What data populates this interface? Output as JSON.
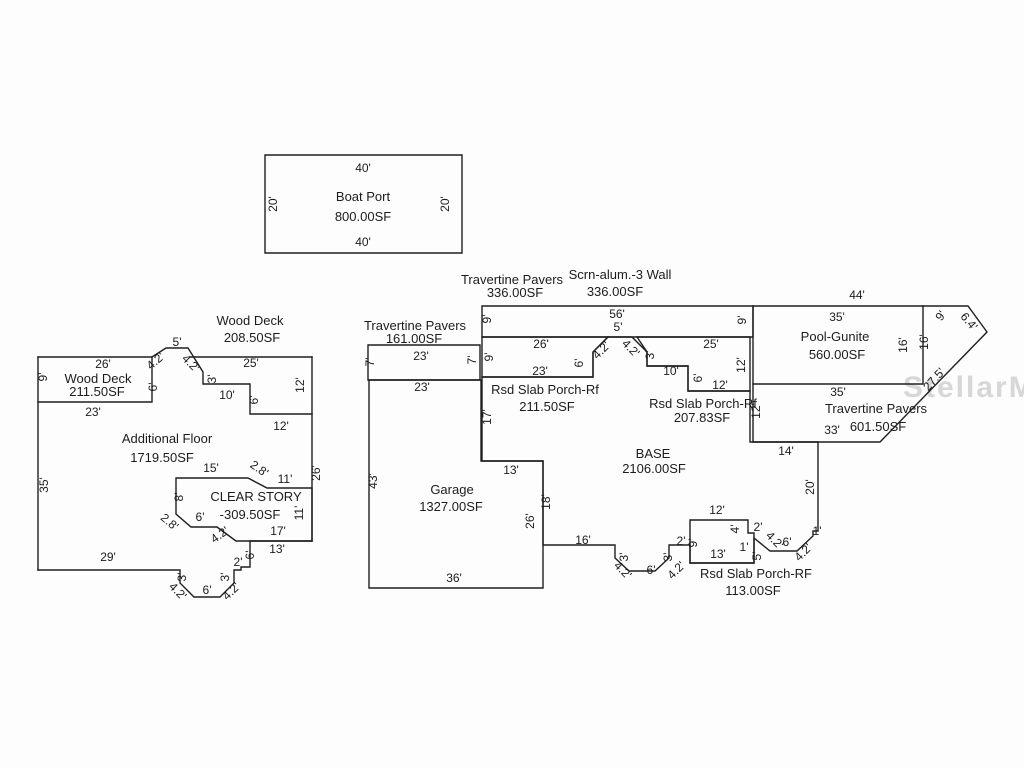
{
  "watermark": "StellarMLS",
  "diagram": {
    "groups": [
      {
        "name": "boat-port",
        "labels": [
          {
            "t": "40'",
            "x": 363,
            "y": 172,
            "cls": "dim"
          },
          {
            "t": "Boat Port",
            "x": 363,
            "y": 201,
            "cls": "area"
          },
          {
            "t": "800.00SF",
            "x": 363,
            "y": 221,
            "cls": "area"
          },
          {
            "t": "40'",
            "x": 363,
            "y": 246,
            "cls": "dim"
          },
          {
            "t": "20'",
            "x": 277,
            "y": 204,
            "r": -90,
            "cls": "dim"
          },
          {
            "t": "20'",
            "x": 449,
            "y": 204,
            "r": -90,
            "cls": "dim"
          }
        ]
      },
      {
        "name": "left-building",
        "labels": [
          {
            "t": "Wood Deck",
            "x": 250,
            "y": 325,
            "cls": "area"
          },
          {
            "t": "208.50SF",
            "x": 252,
            "y": 342,
            "cls": "area"
          },
          {
            "t": "26'",
            "x": 103,
            "y": 368,
            "cls": "dim"
          },
          {
            "t": "5'",
            "x": 177,
            "y": 346,
            "cls": "dim"
          },
          {
            "t": "4.2'",
            "x": 158,
            "y": 364,
            "r": -40,
            "cls": "dim"
          },
          {
            "t": "4.2'",
            "x": 188,
            "y": 366,
            "r": 45,
            "cls": "dim"
          },
          {
            "t": "25'",
            "x": 251,
            "y": 367,
            "cls": "dim"
          },
          {
            "t": "9'",
            "x": 47,
            "y": 377,
            "r": -90,
            "cls": "dim"
          },
          {
            "t": "Wood Deck",
            "x": 98,
            "y": 383,
            "cls": "area"
          },
          {
            "t": "211.50SF",
            "x": 97,
            "y": 396,
            "cls": "area"
          },
          {
            "t": "23'",
            "x": 93,
            "y": 416,
            "cls": "dim"
          },
          {
            "t": "6'",
            "x": 157,
            "y": 387,
            "r": -90,
            "cls": "dim"
          },
          {
            "t": "3'",
            "x": 216,
            "y": 379,
            "r": -90,
            "cls": "dim"
          },
          {
            "t": "10'",
            "x": 227,
            "y": 399,
            "cls": "dim"
          },
          {
            "t": "6'",
            "x": 258,
            "y": 400,
            "r": -90,
            "cls": "dim"
          },
          {
            "t": "12'",
            "x": 304,
            "y": 385,
            "r": -90,
            "cls": "dim"
          },
          {
            "t": "12'",
            "x": 281,
            "y": 430,
            "cls": "dim"
          },
          {
            "t": "26'",
            "x": 320,
            "y": 473,
            "r": -90,
            "cls": "dim"
          },
          {
            "t": "Additional Floor",
            "x": 167,
            "y": 443,
            "cls": "area"
          },
          {
            "t": "1719.50SF",
            "x": 162,
            "y": 462,
            "cls": "area"
          },
          {
            "t": "35'",
            "x": 48,
            "y": 485,
            "r": -90,
            "cls": "dim"
          },
          {
            "t": "15'",
            "x": 211,
            "y": 472,
            "cls": "dim"
          },
          {
            "t": "2.8'",
            "x": 257,
            "y": 472,
            "r": 35,
            "cls": "dim"
          },
          {
            "t": "11'",
            "x": 285,
            "y": 483,
            "cls": "dim"
          },
          {
            "t": "8'",
            "x": 183,
            "y": 497,
            "r": -90,
            "cls": "dim"
          },
          {
            "t": "CLEAR STORY",
            "x": 256,
            "y": 501,
            "cls": "area"
          },
          {
            "t": "-309.50SF",
            "x": 250,
            "y": 519,
            "cls": "area"
          },
          {
            "t": "11'",
            "x": 303,
            "y": 513,
            "r": -90,
            "cls": "dim"
          },
          {
            "t": "6'",
            "x": 200,
            "y": 521,
            "cls": "dim"
          },
          {
            "t": "2.8'",
            "x": 167,
            "y": 525,
            "r": 40,
            "cls": "dim"
          },
          {
            "t": "4.2'",
            "x": 222,
            "y": 538,
            "r": -35,
            "cls": "dim"
          },
          {
            "t": "17'",
            "x": 278,
            "y": 535,
            "cls": "dim"
          },
          {
            "t": "13'",
            "x": 277,
            "y": 553,
            "cls": "dim"
          },
          {
            "t": "6'",
            "x": 254,
            "y": 555,
            "r": -90,
            "cls": "dim"
          },
          {
            "t": "2'",
            "x": 238,
            "y": 566,
            "cls": "dim"
          },
          {
            "t": "3'",
            "x": 229,
            "y": 577,
            "r": -90,
            "cls": "dim"
          },
          {
            "t": "3'",
            "x": 186,
            "y": 577,
            "r": -90,
            "cls": "dim"
          },
          {
            "t": "4.2'",
            "x": 175,
            "y": 594,
            "r": 45,
            "cls": "dim"
          },
          {
            "t": "6'",
            "x": 207,
            "y": 594,
            "cls": "dim"
          },
          {
            "t": "4.2'",
            "x": 234,
            "y": 594,
            "r": -45,
            "cls": "dim"
          },
          {
            "t": "29'",
            "x": 108,
            "y": 561,
            "cls": "dim"
          }
        ]
      },
      {
        "name": "garage-travertine",
        "labels": [
          {
            "t": "Travertine Pavers",
            "x": 415,
            "y": 330,
            "cls": "hdr"
          },
          {
            "t": "161.00SF",
            "x": 414,
            "y": 343,
            "cls": "hdr"
          },
          {
            "t": "23'",
            "x": 421,
            "y": 360,
            "cls": "dim"
          },
          {
            "t": "7'",
            "x": 374,
            "y": 362,
            "r": -90,
            "cls": "dim"
          },
          {
            "t": "7'",
            "x": 476,
            "y": 360,
            "r": -90,
            "cls": "dim"
          },
          {
            "t": "23'",
            "x": 422,
            "y": 391,
            "cls": "dim"
          },
          {
            "t": "Garage",
            "x": 452,
            "y": 494,
            "cls": "area"
          },
          {
            "t": "1327.00SF",
            "x": 451,
            "y": 511,
            "cls": "area"
          },
          {
            "t": "43'",
            "x": 377,
            "y": 481,
            "r": -90,
            "cls": "dim"
          },
          {
            "t": "36'",
            "x": 454,
            "y": 582,
            "cls": "dim"
          },
          {
            "t": "13'",
            "x": 511,
            "y": 474,
            "cls": "dim"
          },
          {
            "t": "26'",
            "x": 534,
            "y": 521,
            "r": -90,
            "cls": "dim"
          },
          {
            "t": "18'",
            "x": 550,
            "y": 502,
            "r": -90,
            "cls": "dim"
          },
          {
            "t": "16'",
            "x": 583,
            "y": 544,
            "cls": "dim"
          }
        ]
      },
      {
        "name": "screen-wall-strip",
        "labels": [
          {
            "t": "Travertine Pavers",
            "x": 512,
            "y": 284,
            "cls": "hdr"
          },
          {
            "t": "336.00SF",
            "x": 515,
            "y": 297,
            "cls": "hdr"
          },
          {
            "t": "Scrn-alum.-3 Wall",
            "x": 620,
            "y": 279,
            "cls": "hdr"
          },
          {
            "t": "336.00SF",
            "x": 615,
            "y": 296,
            "cls": "hdr"
          },
          {
            "t": "56'",
            "x": 617,
            "y": 318,
            "cls": "dim"
          },
          {
            "t": "5'",
            "x": 618,
            "y": 331,
            "cls": "dim"
          },
          {
            "t": "9'",
            "x": 491,
            "y": 319,
            "r": -90,
            "cls": "dim"
          },
          {
            "t": "9'",
            "x": 746,
            "y": 320,
            "r": -90,
            "cls": "dim"
          }
        ]
      },
      {
        "name": "porches",
        "labels": [
          {
            "t": "26'",
            "x": 541,
            "y": 348,
            "cls": "dim"
          },
          {
            "t": "9'",
            "x": 493,
            "y": 357,
            "r": -90,
            "cls": "dim"
          },
          {
            "t": "6'",
            "x": 583,
            "y": 363,
            "r": -90,
            "cls": "dim"
          },
          {
            "t": "4.2'",
            "x": 604,
            "y": 353,
            "r": -45,
            "cls": "dim"
          },
          {
            "t": "23'",
            "x": 540,
            "y": 375,
            "cls": "dim"
          },
          {
            "t": "Rsd Slab Porch-Rf",
            "x": 545,
            "y": 394,
            "cls": "area"
          },
          {
            "t": "211.50SF",
            "x": 547,
            "y": 411,
            "cls": "area"
          },
          {
            "t": "4.2'",
            "x": 628,
            "y": 351,
            "r": 45,
            "cls": "dim"
          },
          {
            "t": "3'",
            "x": 654,
            "y": 355,
            "r": -90,
            "cls": "dim"
          },
          {
            "t": "10'",
            "x": 671,
            "y": 375,
            "cls": "dim"
          },
          {
            "t": "6'",
            "x": 702,
            "y": 378,
            "r": -90,
            "cls": "dim"
          },
          {
            "t": "25'",
            "x": 711,
            "y": 348,
            "cls": "dim"
          },
          {
            "t": "12'",
            "x": 745,
            "y": 365,
            "r": -90,
            "cls": "dim"
          },
          {
            "t": "12'",
            "x": 720,
            "y": 389,
            "cls": "dim"
          },
          {
            "t": "Rsd Slab Porch-Rf",
            "x": 703,
            "y": 408,
            "cls": "area"
          },
          {
            "t": "207.83SF",
            "x": 702,
            "y": 422,
            "cls": "area"
          }
        ]
      },
      {
        "name": "base",
        "labels": [
          {
            "t": "BASE",
            "x": 653,
            "y": 458,
            "cls": "area"
          },
          {
            "t": "2106.00SF",
            "x": 654,
            "y": 473,
            "cls": "area"
          },
          {
            "t": "17'",
            "x": 491,
            "y": 417,
            "r": -90,
            "cls": "dim"
          },
          {
            "t": "14'",
            "x": 786,
            "y": 455,
            "cls": "dim"
          },
          {
            "t": "20'",
            "x": 814,
            "y": 487,
            "r": -90,
            "cls": "dim"
          },
          {
            "t": "12'",
            "x": 760,
            "y": 411,
            "r": -90,
            "cls": "dim"
          },
          {
            "t": "1'",
            "x": 817,
            "y": 535,
            "cls": "dim"
          },
          {
            "t": "4.2'",
            "x": 806,
            "y": 555,
            "r": -45,
            "cls": "dim"
          },
          {
            "t": "6'",
            "x": 787,
            "y": 546,
            "cls": "dim"
          },
          {
            "t": "4.2'",
            "x": 772,
            "y": 543,
            "r": 45,
            "cls": "dim"
          },
          {
            "t": "2'",
            "x": 758,
            "y": 531,
            "cls": "dim"
          },
          {
            "t": "4'",
            "x": 739,
            "y": 529,
            "r": -90,
            "cls": "dim"
          },
          {
            "t": "1'",
            "x": 744,
            "y": 551,
            "cls": "dim"
          },
          {
            "t": "5'",
            "x": 761,
            "y": 556,
            "r": -90,
            "cls": "dim"
          },
          {
            "t": "12'",
            "x": 717,
            "y": 514,
            "cls": "dim"
          },
          {
            "t": "13'",
            "x": 718,
            "y": 558,
            "cls": "dim"
          },
          {
            "t": "9'",
            "x": 697,
            "y": 543,
            "r": -90,
            "cls": "dim"
          },
          {
            "t": "2'",
            "x": 681,
            "y": 545,
            "cls": "dim"
          },
          {
            "t": "3'",
            "x": 672,
            "y": 557,
            "r": -90,
            "cls": "dim"
          },
          {
            "t": "4.2'",
            "x": 679,
            "y": 573,
            "r": -45,
            "cls": "dim"
          },
          {
            "t": "6'",
            "x": 651,
            "y": 574,
            "cls": "dim"
          },
          {
            "t": "4.2'",
            "x": 620,
            "y": 573,
            "r": 45,
            "cls": "dim"
          },
          {
            "t": "3'",
            "x": 628,
            "y": 557,
            "r": -90,
            "cls": "dim"
          },
          {
            "t": "Rsd Slab Porch-RF",
            "x": 756,
            "y": 578,
            "cls": "area"
          },
          {
            "t": "113.00SF",
            "x": 753,
            "y": 595,
            "cls": "area"
          }
        ]
      },
      {
        "name": "pool",
        "labels": [
          {
            "t": "44'",
            "x": 857,
            "y": 299,
            "cls": "dim"
          },
          {
            "t": "35'",
            "x": 837,
            "y": 321,
            "cls": "dim"
          },
          {
            "t": "Pool-Gunite",
            "x": 835,
            "y": 341,
            "cls": "area"
          },
          {
            "t": "560.00SF",
            "x": 837,
            "y": 359,
            "cls": "area"
          },
          {
            "t": "16'",
            "x": 907,
            "y": 345,
            "r": -90,
            "cls": "dim"
          },
          {
            "t": "16'",
            "x": 928,
            "y": 342,
            "r": -90,
            "cls": "dim"
          },
          {
            "t": "9'",
            "x": 944,
            "y": 318,
            "r": -55,
            "cls": "dim"
          },
          {
            "t": "6.4'",
            "x": 966,
            "y": 324,
            "r": 50,
            "cls": "dim"
          },
          {
            "t": "27.5'",
            "x": 937,
            "y": 382,
            "r": -48,
            "cls": "dim"
          },
          {
            "t": "35'",
            "x": 838,
            "y": 396,
            "cls": "dim"
          },
          {
            "t": "Travertine Pavers",
            "x": 876,
            "y": 413,
            "cls": "area"
          },
          {
            "t": "601.50SF",
            "x": 878,
            "y": 431,
            "cls": "area"
          },
          {
            "t": "33'",
            "x": 832,
            "y": 434,
            "cls": "dim"
          }
        ]
      }
    ]
  }
}
